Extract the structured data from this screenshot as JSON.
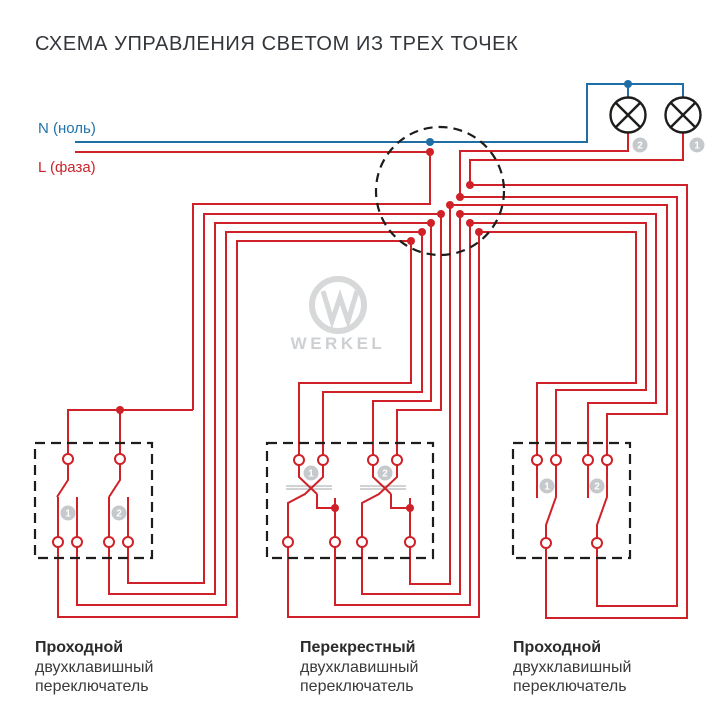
{
  "title": "СХЕМА УПРАВЛЕНИЯ СВЕТОМ ИЗ ТРЕХ ТОЧЕК",
  "colors": {
    "wire_phase_red": "#cf2127",
    "wire_neutral_blue": "#1f6ea6",
    "outline_black": "#1d1d1b",
    "badge_gray": "#c6c9cb",
    "watermark_gray": "#d6d8d9"
  },
  "feed": {
    "neutral_label": "N (ноль)",
    "phase_label": "L (фаза)"
  },
  "lamps": [
    {
      "badge": "1"
    },
    {
      "badge": "2"
    }
  ],
  "junction_box": {
    "type": "dashed-circle"
  },
  "watermark": {
    "brand": "WERKEL"
  },
  "switches": [
    {
      "position": "left",
      "caption_line1": "Проходной",
      "caption_line2": "двухклавишный",
      "caption_line3": "переключатель",
      "keys": [
        "1",
        "2"
      ]
    },
    {
      "position": "middle",
      "caption_line1": "Перекрестный",
      "caption_line2": "двухклавишный",
      "caption_line3": "переключатель",
      "keys": [
        "1",
        "2"
      ]
    },
    {
      "position": "right",
      "caption_line1": "Проходной",
      "caption_line2": "двухклавишный",
      "caption_line3": "переключатель",
      "keys": [
        "1",
        "2"
      ]
    }
  ]
}
